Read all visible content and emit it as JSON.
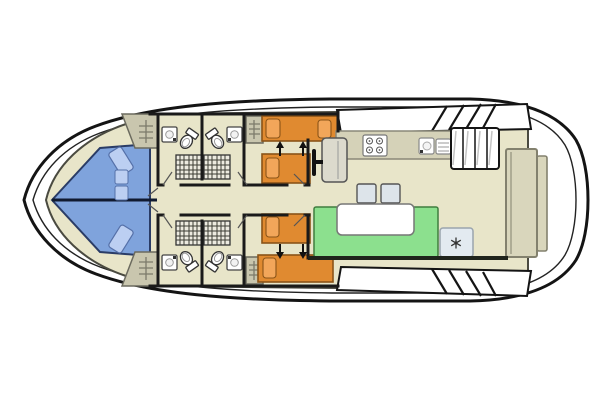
{
  "page": {
    "background": "#ffffff",
    "width": 600,
    "height": 400
  },
  "plan": {
    "type": "boat-deck-floor-plan",
    "colors": {
      "hull_fill": "#ffffff",
      "outline": "#141414",
      "floor": "#e8e5c9",
      "wall": "#1a1a1a",
      "v_berth": "#7fa3dc",
      "v_berth_pillow": "#bccff2",
      "bed": "#e08a30",
      "bed_pillow": "#f2a65a",
      "bench": "#8ce08e",
      "table": "#ffffff",
      "counter": "#d5d2b8",
      "appliance": "#ffffff",
      "wardrobe": "#c9c6ae",
      "helm_seat": "#dcdacd",
      "stool": "#dde4ea",
      "fridge": "#e3eaf0",
      "stern_door": "#d9d6bc",
      "shower": "#eceae0",
      "deck": "#ffffff"
    },
    "icons": {
      "snowflake": "refrigerator",
      "burner_circles": "stove",
      "toilet_oval": "toilet",
      "sink_square": "washbasin",
      "shower_grid": "shower",
      "shelf_ladder": "wardrobe-shelves",
      "double_arrows": "beds-combinable",
      "diagonal_hatch": "deck-steps",
      "vertical_treads": "companionway-steps",
      "wheel_bar": "helm-steering-wheel"
    },
    "counts": {
      "double_berth_bow": 1,
      "single_beds": 4,
      "bathrooms": 4,
      "toilets": 4,
      "showers": 4,
      "washbasins": 4,
      "wardrobes": 4,
      "stools": 2
    }
  }
}
